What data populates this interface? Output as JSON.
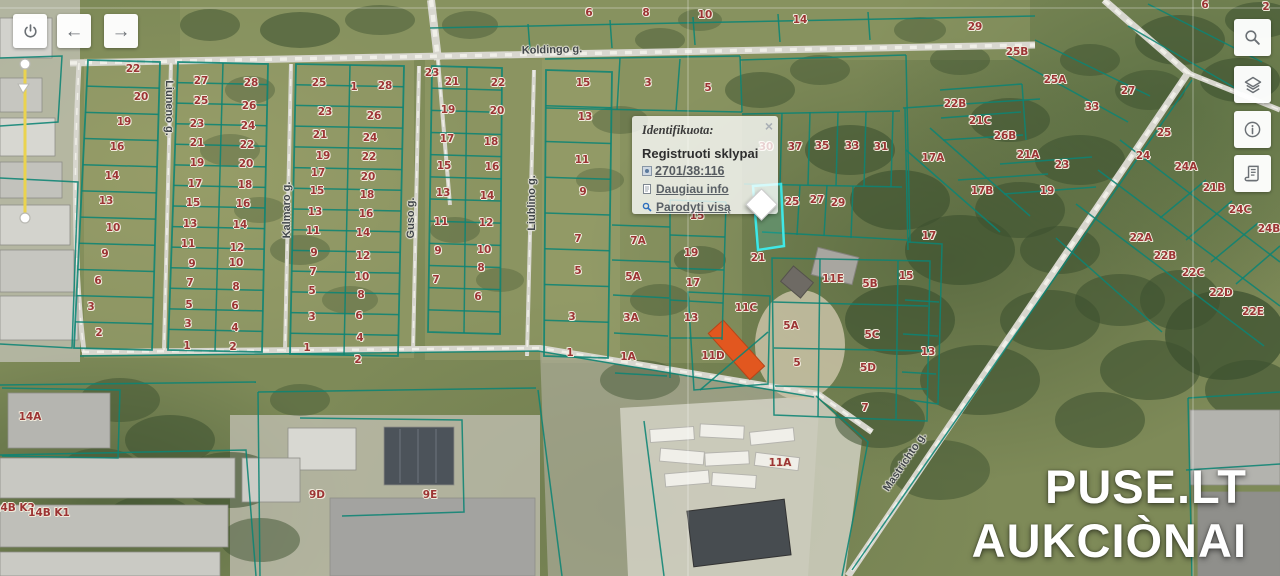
{
  "popup": {
    "title": "Identifikuota:",
    "close": "×",
    "subtitle": "Registruoti sklypai",
    "parcel_link": "2701/38:116",
    "link_more": "Daugiau info",
    "link_show_all": "Parodyti visą"
  },
  "watermark": {
    "line1": "PUSE.LT",
    "line2": "AUKCIÒNAI"
  },
  "toolbar_left": [
    {
      "icon": "power-icon"
    },
    {
      "icon": "arrow-left-icon",
      "glyph": "←"
    },
    {
      "icon": "arrow-right-icon",
      "glyph": "→"
    }
  ],
  "toolbar_right": [
    {
      "icon": "search-icon"
    },
    {
      "icon": "layers-icon"
    },
    {
      "icon": "info-icon"
    },
    {
      "icon": "legend-icon"
    }
  ],
  "colors": {
    "parcel_line": "#0d8474",
    "highlight": "#3fe8e6",
    "label": "#9c3434",
    "road": "#d8d7cf",
    "link_blue": "#2f6fbe"
  },
  "streets": [
    {
      "t": "Koldingo g.",
      "x": 552,
      "y": 50,
      "r": -1.5
    },
    {
      "t": "Liuneno g.",
      "x": 169,
      "y": 108,
      "r": 90
    },
    {
      "t": "Kalmaro g.",
      "x": 287,
      "y": 210,
      "r": -90
    },
    {
      "t": "Guso g.",
      "x": 411,
      "y": 218,
      "r": -90
    },
    {
      "t": "Liublino g.",
      "x": 532,
      "y": 203,
      "r": -90
    },
    {
      "t": "Mastrichto g.",
      "x": 905,
      "y": 462,
      "r": -56
    }
  ],
  "parcels": [
    {
      "t": "22",
      "x": 133,
      "y": 69
    },
    {
      "t": "20",
      "x": 141,
      "y": 97
    },
    {
      "t": "19",
      "x": 124,
      "y": 122
    },
    {
      "t": "16",
      "x": 117,
      "y": 147
    },
    {
      "t": "14",
      "x": 112,
      "y": 176
    },
    {
      "t": "13",
      "x": 106,
      "y": 201
    },
    {
      "t": "10",
      "x": 113,
      "y": 228
    },
    {
      "t": "9",
      "x": 105,
      "y": 254
    },
    {
      "t": "6",
      "x": 98,
      "y": 281
    },
    {
      "t": "3",
      "x": 91,
      "y": 307
    },
    {
      "t": "2",
      "x": 99,
      "y": 333
    },
    {
      "t": "27",
      "x": 201,
      "y": 81
    },
    {
      "t": "25",
      "x": 201,
      "y": 101
    },
    {
      "t": "23",
      "x": 197,
      "y": 124
    },
    {
      "t": "21",
      "x": 197,
      "y": 143
    },
    {
      "t": "19",
      "x": 197,
      "y": 163
    },
    {
      "t": "17",
      "x": 195,
      "y": 184
    },
    {
      "t": "15",
      "x": 193,
      "y": 203
    },
    {
      "t": "13",
      "x": 190,
      "y": 224
    },
    {
      "t": "11",
      "x": 188,
      "y": 244
    },
    {
      "t": "9",
      "x": 192,
      "y": 264
    },
    {
      "t": "7",
      "x": 190,
      "y": 283
    },
    {
      "t": "5",
      "x": 189,
      "y": 305
    },
    {
      "t": "3",
      "x": 188,
      "y": 324
    },
    {
      "t": "1",
      "x": 187,
      "y": 346
    },
    {
      "t": "28",
      "x": 251,
      "y": 83
    },
    {
      "t": "26",
      "x": 249,
      "y": 106
    },
    {
      "t": "24",
      "x": 248,
      "y": 126
    },
    {
      "t": "22",
      "x": 247,
      "y": 145
    },
    {
      "t": "20",
      "x": 246,
      "y": 164
    },
    {
      "t": "18",
      "x": 245,
      "y": 185
    },
    {
      "t": "16",
      "x": 243,
      "y": 204
    },
    {
      "t": "14",
      "x": 240,
      "y": 225
    },
    {
      "t": "12",
      "x": 237,
      "y": 248
    },
    {
      "t": "10",
      "x": 236,
      "y": 263
    },
    {
      "t": "8",
      "x": 236,
      "y": 287
    },
    {
      "t": "6",
      "x": 235,
      "y": 306
    },
    {
      "t": "4",
      "x": 235,
      "y": 328
    },
    {
      "t": "2",
      "x": 233,
      "y": 347
    },
    {
      "t": "25",
      "x": 319,
      "y": 83
    },
    {
      "t": "23",
      "x": 325,
      "y": 112
    },
    {
      "t": "21",
      "x": 320,
      "y": 135
    },
    {
      "t": "19",
      "x": 323,
      "y": 156
    },
    {
      "t": "17",
      "x": 318,
      "y": 173
    },
    {
      "t": "15",
      "x": 317,
      "y": 191
    },
    {
      "t": "13",
      "x": 315,
      "y": 212
    },
    {
      "t": "11",
      "x": 313,
      "y": 231
    },
    {
      "t": "9",
      "x": 314,
      "y": 253
    },
    {
      "t": "7",
      "x": 313,
      "y": 272
    },
    {
      "t": "5",
      "x": 312,
      "y": 291
    },
    {
      "t": "3",
      "x": 312,
      "y": 317
    },
    {
      "t": "1",
      "x": 307,
      "y": 348
    },
    {
      "t": "1",
      "x": 354,
      "y": 87
    },
    {
      "t": "28",
      "x": 385,
      "y": 86
    },
    {
      "t": "26",
      "x": 374,
      "y": 116
    },
    {
      "t": "24",
      "x": 370,
      "y": 138
    },
    {
      "t": "22",
      "x": 369,
      "y": 157
    },
    {
      "t": "20",
      "x": 368,
      "y": 177
    },
    {
      "t": "18",
      "x": 367,
      "y": 195
    },
    {
      "t": "16",
      "x": 366,
      "y": 214
    },
    {
      "t": "14",
      "x": 363,
      "y": 233
    },
    {
      "t": "12",
      "x": 363,
      "y": 256
    },
    {
      "t": "10",
      "x": 362,
      "y": 277
    },
    {
      "t": "8",
      "x": 361,
      "y": 295
    },
    {
      "t": "6",
      "x": 359,
      "y": 316
    },
    {
      "t": "4",
      "x": 360,
      "y": 338
    },
    {
      "t": "2",
      "x": 358,
      "y": 360
    },
    {
      "t": "23",
      "x": 432,
      "y": 73
    },
    {
      "t": "21",
      "x": 452,
      "y": 82
    },
    {
      "t": "19",
      "x": 448,
      "y": 110
    },
    {
      "t": "17",
      "x": 447,
      "y": 139
    },
    {
      "t": "15",
      "x": 444,
      "y": 166
    },
    {
      "t": "13",
      "x": 443,
      "y": 193
    },
    {
      "t": "11",
      "x": 441,
      "y": 222
    },
    {
      "t": "9",
      "x": 438,
      "y": 251
    },
    {
      "t": "7",
      "x": 436,
      "y": 280
    },
    {
      "t": "22",
      "x": 498,
      "y": 83
    },
    {
      "t": "20",
      "x": 497,
      "y": 111
    },
    {
      "t": "18",
      "x": 491,
      "y": 142
    },
    {
      "t": "16",
      "x": 492,
      "y": 167
    },
    {
      "t": "14",
      "x": 487,
      "y": 196
    },
    {
      "t": "12",
      "x": 486,
      "y": 223
    },
    {
      "t": "10",
      "x": 484,
      "y": 250
    },
    {
      "t": "8",
      "x": 481,
      "y": 268
    },
    {
      "t": "6",
      "x": 478,
      "y": 297
    },
    {
      "t": "15",
      "x": 583,
      "y": 83
    },
    {
      "t": "13",
      "x": 585,
      "y": 117
    },
    {
      "t": "11",
      "x": 582,
      "y": 160
    },
    {
      "t": "9",
      "x": 583,
      "y": 192
    },
    {
      "t": "7",
      "x": 578,
      "y": 239
    },
    {
      "t": "5",
      "x": 578,
      "y": 271
    },
    {
      "t": "3",
      "x": 572,
      "y": 317
    },
    {
      "t": "1",
      "x": 570,
      "y": 353
    },
    {
      "t": "7A",
      "x": 638,
      "y": 241
    },
    {
      "t": "5A",
      "x": 633,
      "y": 277
    },
    {
      "t": "3A",
      "x": 631,
      "y": 318
    },
    {
      "t": "1A",
      "x": 628,
      "y": 357
    },
    {
      "t": "3",
      "x": 648,
      "y": 83
    },
    {
      "t": "5",
      "x": 708,
      "y": 88
    },
    {
      "t": "15",
      "x": 697,
      "y": 216
    },
    {
      "t": "19",
      "x": 691,
      "y": 253
    },
    {
      "t": "17",
      "x": 693,
      "y": 283
    },
    {
      "t": "13",
      "x": 691,
      "y": 318
    },
    {
      "t": "6",
      "x": 589,
      "y": 13
    },
    {
      "t": "8",
      "x": 646,
      "y": 13
    },
    {
      "t": "10",
      "x": 705,
      "y": 15
    },
    {
      "t": "14",
      "x": 800,
      "y": 20
    },
    {
      "t": "6",
      "x": 1205,
      "y": 5
    },
    {
      "t": "2",
      "x": 1266,
      "y": 7
    },
    {
      "t": "30",
      "x": 766,
      "y": 147
    },
    {
      "t": "37",
      "x": 795,
      "y": 147
    },
    {
      "t": "35",
      "x": 822,
      "y": 146
    },
    {
      "t": "33",
      "x": 852,
      "y": 146
    },
    {
      "t": "31",
      "x": 881,
      "y": 147
    },
    {
      "t": "25",
      "x": 792,
      "y": 202
    },
    {
      "t": "27",
      "x": 817,
      "y": 200
    },
    {
      "t": "29",
      "x": 838,
      "y": 203
    },
    {
      "t": "21",
      "x": 758,
      "y": 258
    },
    {
      "t": "11C",
      "x": 746,
      "y": 308
    },
    {
      "t": "11D",
      "x": 713,
      "y": 356
    },
    {
      "t": "11E",
      "x": 833,
      "y": 279
    },
    {
      "t": "5B",
      "x": 870,
      "y": 284
    },
    {
      "t": "5C",
      "x": 872,
      "y": 335
    },
    {
      "t": "5A",
      "x": 791,
      "y": 326
    },
    {
      "t": "5",
      "x": 797,
      "y": 363
    },
    {
      "t": "5D",
      "x": 868,
      "y": 368
    },
    {
      "t": "15",
      "x": 906,
      "y": 276
    },
    {
      "t": "13",
      "x": 928,
      "y": 352
    },
    {
      "t": "7",
      "x": 865,
      "y": 408
    },
    {
      "t": "17",
      "x": 929,
      "y": 236
    },
    {
      "t": "29",
      "x": 975,
      "y": 27
    },
    {
      "t": "25B",
      "x": 1017,
      "y": 52
    },
    {
      "t": "25A",
      "x": 1055,
      "y": 80
    },
    {
      "t": "27",
      "x": 1128,
      "y": 91
    },
    {
      "t": "33",
      "x": 1092,
      "y": 107
    },
    {
      "t": "22B",
      "x": 955,
      "y": 104
    },
    {
      "t": "21C",
      "x": 980,
      "y": 121
    },
    {
      "t": "26B",
      "x": 1005,
      "y": 136
    },
    {
      "t": "17A",
      "x": 933,
      "y": 158
    },
    {
      "t": "21A",
      "x": 1028,
      "y": 155
    },
    {
      "t": "23",
      "x": 1062,
      "y": 165
    },
    {
      "t": "19",
      "x": 1047,
      "y": 191
    },
    {
      "t": "17B",
      "x": 982,
      "y": 191
    },
    {
      "t": "25",
      "x": 1164,
      "y": 133
    },
    {
      "t": "24",
      "x": 1143,
      "y": 156
    },
    {
      "t": "24A",
      "x": 1186,
      "y": 167
    },
    {
      "t": "21B",
      "x": 1214,
      "y": 188
    },
    {
      "t": "24C",
      "x": 1240,
      "y": 210
    },
    {
      "t": "24B",
      "x": 1269,
      "y": 229
    },
    {
      "t": "22A",
      "x": 1141,
      "y": 238
    },
    {
      "t": "22B",
      "x": 1165,
      "y": 256
    },
    {
      "t": "22C",
      "x": 1193,
      "y": 273
    },
    {
      "t": "22D",
      "x": 1221,
      "y": 293
    },
    {
      "t": "22E",
      "x": 1253,
      "y": 312
    },
    {
      "t": "14A",
      "x": 30,
      "y": 417
    },
    {
      "t": "14B K2",
      "x": 14,
      "y": 508
    },
    {
      "t": "14B K1",
      "x": 49,
      "y": 513
    },
    {
      "t": "9D",
      "x": 317,
      "y": 495
    },
    {
      "t": "9E",
      "x": 430,
      "y": 495
    },
    {
      "t": "11A",
      "x": 780,
      "y": 463
    }
  ]
}
